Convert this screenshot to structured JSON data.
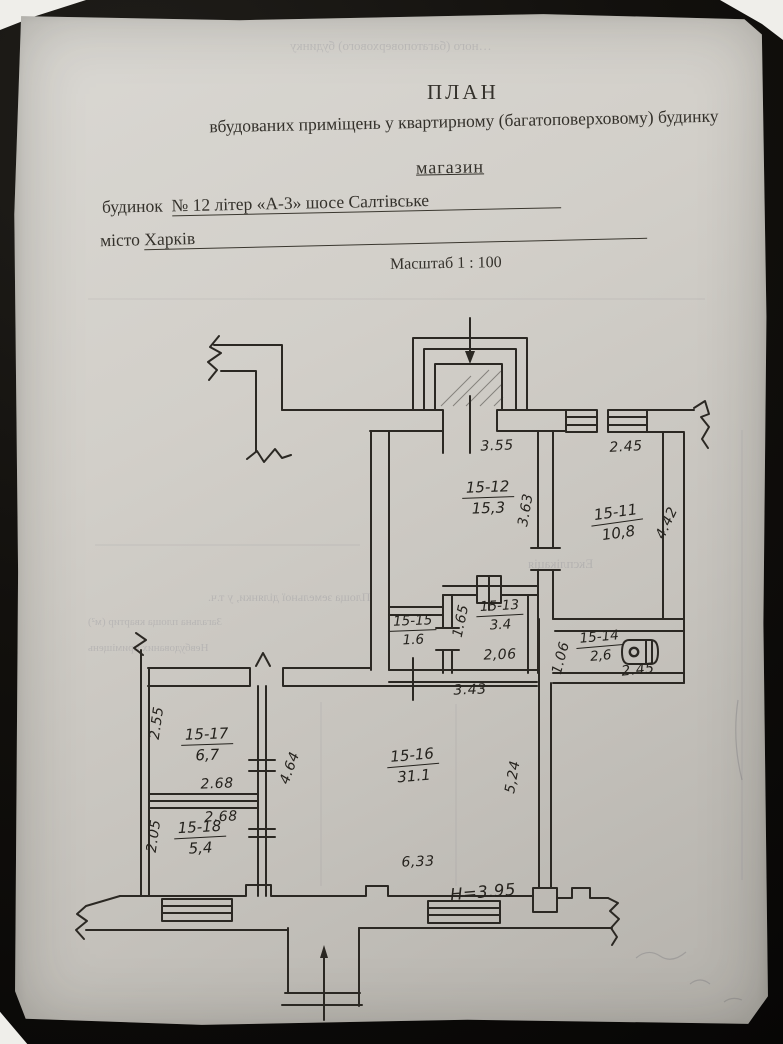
{
  "document": {
    "title": "ПЛАН",
    "subtitle": "вбудованих приміщень у квартирному (багатоповерховому) будинку",
    "object_type": "магазин",
    "building_label": "будинок",
    "building_value": "№ 12  літер «А-3» шосе Салтівське",
    "city_label": "місто",
    "city_value": "Харків",
    "scale": "Масштаб 1 : 100"
  },
  "plan": {
    "height_note": "Н=3.95",
    "rooms": [
      {
        "number": "15-12",
        "area": "15,3"
      },
      {
        "number": "15-11",
        "area": "10,8"
      },
      {
        "number": "15-13",
        "area": "3.4"
      },
      {
        "number": "15-15",
        "area": "1.6"
      },
      {
        "number": "15-14",
        "area": "2,6"
      },
      {
        "number": "15-16",
        "area": "31.1"
      },
      {
        "number": "15-17",
        "area": "6,7"
      },
      {
        "number": "15-18",
        "area": "5,4"
      }
    ],
    "dimensions": [
      {
        "value": "3.55"
      },
      {
        "value": "2.45"
      },
      {
        "value": "3.63"
      },
      {
        "value": "4.42"
      },
      {
        "value": "1.65"
      },
      {
        "value": "2,06"
      },
      {
        "value": "1.06"
      },
      {
        "value": "2.45"
      },
      {
        "value": "3.43"
      },
      {
        "value": "2.55"
      },
      {
        "value": "2.68"
      },
      {
        "value": "2.68"
      },
      {
        "value": "2.05"
      },
      {
        "value": "4.64"
      },
      {
        "value": "5,24"
      },
      {
        "value": "6,33"
      }
    ]
  },
  "ghost_text": {
    "line_top": "…ного (багатоповерхового) будинку",
    "explication": "Експлікація",
    "land_area": "Площа земельної ділянки, у т.ч.",
    "left1": "Загальна площа квартир (м²)",
    "left2": "Невбудованих приміщень",
    "margin_vertical": "приміщення"
  }
}
